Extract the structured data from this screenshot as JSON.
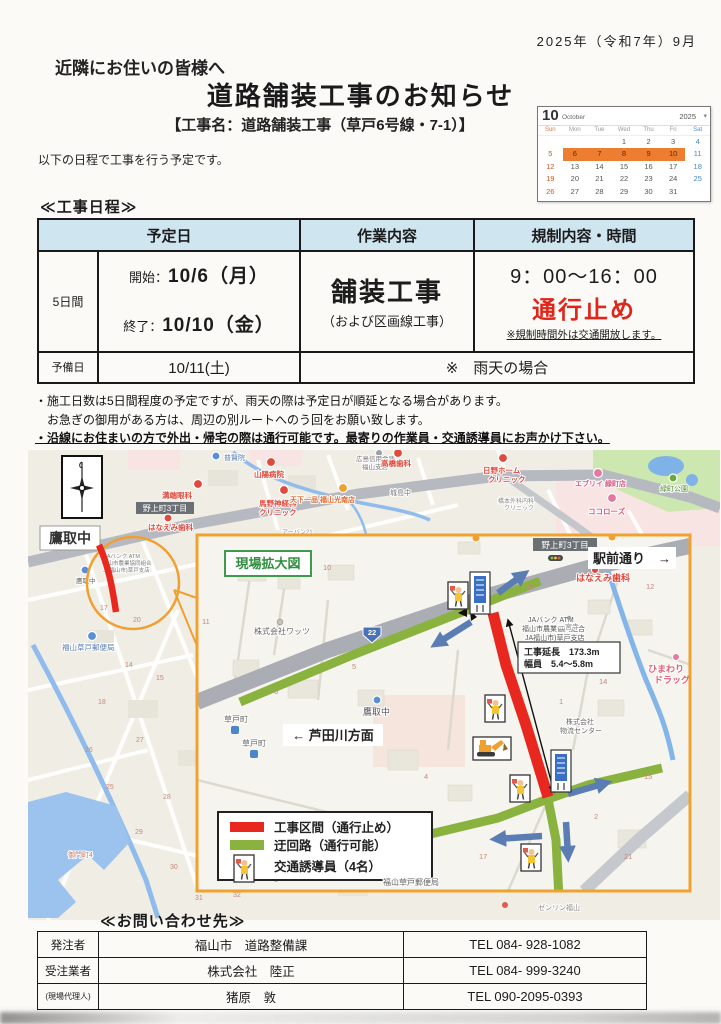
{
  "header": {
    "date": "2025年（令和7年）9月",
    "greeting": "近隣にお住いの皆様へ",
    "title": "道路舗装工事のお知らせ",
    "subtitle": "【工事名：道路舗装工事（草戸6号線・7-1）】",
    "intro": "以下の日程で工事を行う予定です。"
  },
  "calendar": {
    "month_num": "10",
    "month_name": "October",
    "year": "2025",
    "nav": "▾",
    "days": [
      "Sun",
      "Mon",
      "Tue",
      "Wed",
      "Thu",
      "Fri",
      "Sat"
    ],
    "weeks": [
      [
        "",
        "",
        "",
        "1",
        "2",
        "3",
        "4"
      ],
      [
        "5",
        "6",
        "7",
        "8",
        "9",
        "10",
        "11"
      ],
      [
        "12",
        "13",
        "14",
        "15",
        "16",
        "17",
        "18"
      ],
      [
        "19",
        "20",
        "21",
        "22",
        "23",
        "24",
        "25"
      ],
      [
        "26",
        "27",
        "28",
        "29",
        "30",
        "31",
        ""
      ]
    ],
    "highlight_color": "#ed7d31"
  },
  "schedule": {
    "heading": "≪工事日程≫",
    "col_date": "予定日",
    "col_work": "作業内容",
    "col_reg": "規制内容・時間",
    "duration": "5日間",
    "start_label": "開始：",
    "start_date": "10/6（月）",
    "end_label": "終了：",
    "end_date": "10/10（金）",
    "work": "舗装工事",
    "work_sub": "（および区画線工事）",
    "time": "9：00～16：00",
    "restriction": "通行止め",
    "restriction_note": "※規制時間外は交通開放します。",
    "reserve_label": "予備日",
    "reserve_date": "10/11(土)",
    "reserve_note": "※　雨天の場合"
  },
  "notes": {
    "n1": "・施工日数は5日間程度の予定ですが、雨天の際は予定日が順延となる場合があります。",
    "n2": "　お急ぎの御用がある方は、周辺の別ルートへのう回をお願い致します。",
    "n3": "・沿線にお住まいの方で外出・帰宅の際は通行可能です。最寄りの作業員・交通誘導員にお声かけ下さい。"
  },
  "map": {
    "colors": {
      "closed": "#e8281e",
      "detour": "#8ab23e",
      "border": "#f0a230",
      "arrow": "#5a7db3"
    },
    "labels": {
      "fugenin": "普賢院",
      "sanyo": "山陽病院",
      "mizobata": "溝端眼科",
      "umano1": "馬野神経科",
      "umano2": "クリニック",
      "tenka": "天下一品 福山光南店",
      "shinkin1": "広島信用金庫",
      "shinkin2": "福山支店",
      "takahashi": "高橋歯科",
      "hino1": "日野ホーム",
      "hino2": "クリニック",
      "every": "エブリイ 緑町店",
      "midori": "緑町公園",
      "kokoro": "ココローズ",
      "kijima": "城島中",
      "hashimoto1": "橋本外科内科",
      "hashimoto2": "クリニック",
      "urban": "アーバン21",
      "nogami_ov": "野上町3丁目",
      "hanaemi_ov": "はなえみ歯科",
      "takatori_box": "鷹取中",
      "takatori_sm": "鷹取中",
      "post_ov": "福山草戸郵便局",
      "mikado": "御門町4",
      "ja1": "JAバンク ATM",
      "ja2": "福山市農業協同組合",
      "ja3": "JA福山市)草戸支店",
      "genba": "現場拡大図",
      "ekimae": "駅前通り　→",
      "nogami_in": "野上町3丁目",
      "hanaemi_in": "はなえみ歯科",
      "ichinomiya": "一宮寺",
      "himawari1": "ひまわり",
      "himawari2": "ドラッグ",
      "ext1": "工事延長　173.3m",
      "ext2": "幅員　5.4～5.8m",
      "ashida": "← 芦田川方面",
      "takatori_in": "鷹取中",
      "kusado1": "草戸町",
      "kusado2": "草戸町",
      "watts": "株式会社ワッツ",
      "butsu1": "株式会社",
      "butsu2": "物流センター",
      "r22": "22",
      "post_in": "福山草戸郵便局",
      "zenrin": "ゼンリン福山"
    },
    "legend": {
      "item1": "工事区間（通行止め）",
      "item2": "迂回路（通行可能）",
      "item3": "交通誘導員（4名）"
    },
    "nums": [
      "17",
      "20",
      "14",
      "15",
      "18",
      "27",
      "26",
      "25",
      "28",
      "29",
      "30",
      "31",
      "23",
      "32",
      "24"
    ],
    "inums": [
      "10",
      "11",
      "13",
      "12",
      "14",
      "15",
      "1",
      "2",
      "4",
      "5",
      "6",
      "17",
      "21",
      "9"
    ]
  },
  "contact": {
    "heading": "≪お問い合わせ先≫",
    "rows": [
      {
        "role": "発注者",
        "name": "福山市　道路整備課",
        "tel": "TEL 084- 928-1082"
      },
      {
        "role": "受注業者",
        "name": "株式会社　陸正",
        "tel": "TEL 084- 999-3240"
      },
      {
        "role": "(現場代理人)",
        "name": "猪原　敦",
        "tel": "TEL 090-2095-0393"
      }
    ]
  }
}
